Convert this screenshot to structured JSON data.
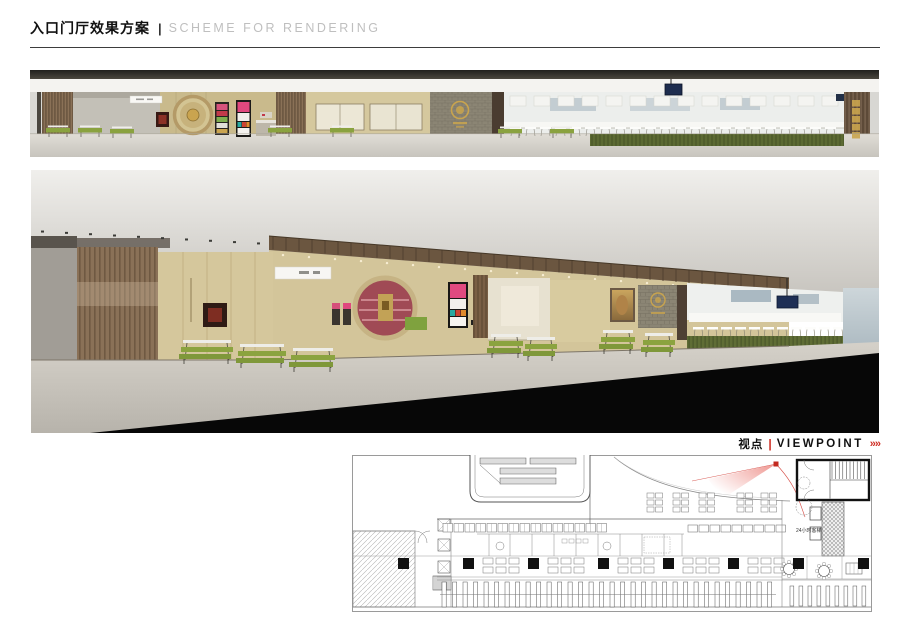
{
  "header": {
    "title_cn": "入口门厅效果方案",
    "separator": "|",
    "title_en": "SCHEME FOR RENDERING"
  },
  "viewpoint": {
    "label_cn": "视点",
    "separator": "|",
    "label_en": "VIEWPOINT",
    "arrows": "»»"
  },
  "floor_plan": {
    "label_24h_elevator": "24小时客梯"
  },
  "colors": {
    "accent_red": "#cf2e24",
    "bench_green": "#8aa23f",
    "hedge_green": "#5c6a33",
    "wall_tan": "#cdbf97",
    "wood_brown": "#7d6750",
    "gold": "#c9a44e",
    "ink": "#111111",
    "muted_gray": "#bfbfbf"
  }
}
